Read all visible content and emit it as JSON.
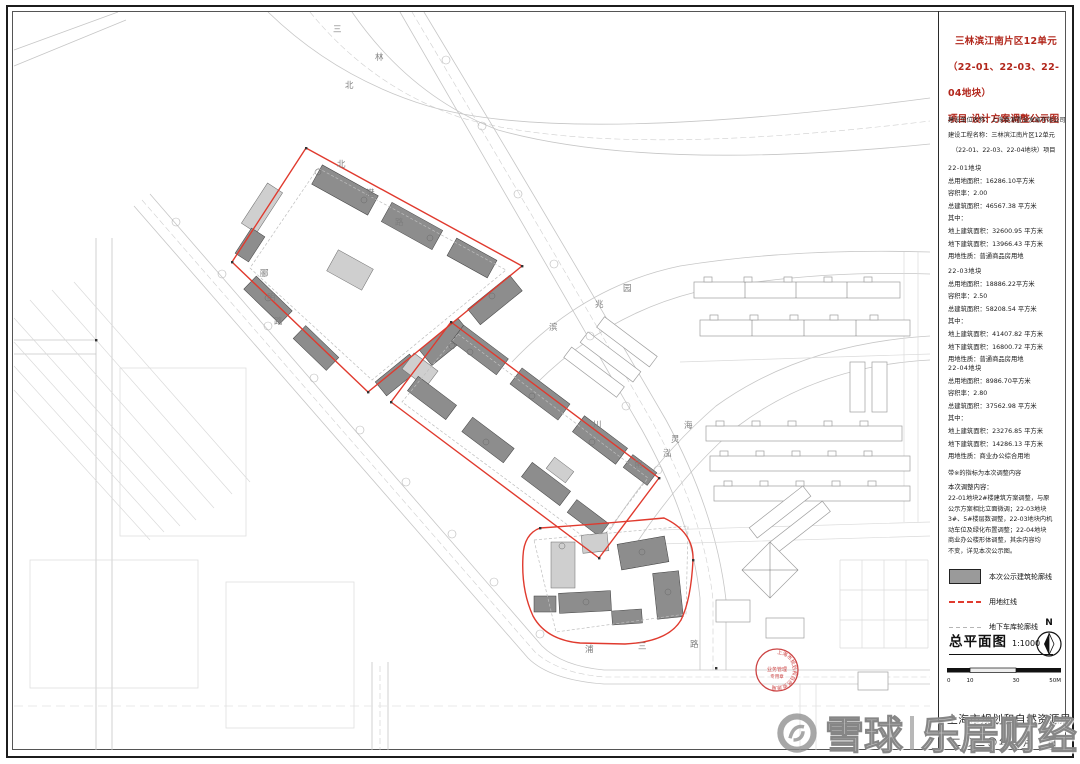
{
  "panel": {
    "title": [
      "三林滨江南片区12单元",
      "（22-01、22-03、22-04地块）",
      "项目 设计方案调整公示图"
    ],
    "meta": [
      "建设单位名称：上海临浦置业发展有限公司",
      "建设工程名称：三林滨江南片区12单元",
      "（22-01、22-03、22-04地块）项目"
    ],
    "parcels": [
      {
        "name": "22-01地块",
        "rows": [
          "总用地面积：16286.10平方米",
          "容积率：2.00",
          "总建筑面积：46567.38 平方米",
          "其中：",
          "地上建筑面积：32600.95 平方米",
          "地下建筑面积：13966.43 平方米",
          "用地性质：普通商品房用地"
        ]
      },
      {
        "name": "22-03地块",
        "rows": [
          "总用地面积：18886.22平方米",
          "容积率：2.50",
          "总建筑面积：58208.54 平方米",
          "其中：",
          "地上建筑面积：41407.82 平方米",
          "地下建筑面积：16800.72 平方米",
          "用地性质：普通商品房用地"
        ]
      },
      {
        "name": "22-04地块",
        "rows": [
          "总用地面积：8986.70平方米",
          "容积率：2.80",
          "总建筑面积：37562.98 平方米",
          "其中：",
          "地上建筑面积：23276.85 平方米",
          "地下建筑面积：14286.13 平方米",
          "用地性质：商业办公综合用地"
        ]
      }
    ],
    "flag_note": "带※的指标为本次调整内容",
    "note_title": "本次调整内容：",
    "note_lines": [
      "22-01地块2#楼建筑方案调整，与原",
      "公示方案相比立面微调；22-03地块",
      "3#、5#楼层数调整，22-03地块内机",
      "动车位及绿化布置调整；22-04地块",
      "商业办公楼形体调整，其余内容均",
      "不变，详见本次公示图。"
    ],
    "legend": [
      {
        "label": "本次公示建筑轮廓线"
      },
      {
        "label": "用地红线"
      },
      {
        "label": "地下车库轮廓线"
      }
    ],
    "plan_label": "总平面图",
    "plan_scale": "1:1000",
    "north": "N",
    "scalebar": [
      "0",
      "10",
      "30",
      "50M"
    ],
    "agency": "上海市规划和自然资源局",
    "date": "二〇二〇年　月　日"
  },
  "map": {
    "streets": [
      {
        "c": "三"
      },
      {
        "c": "林"
      },
      {
        "c": "北"
      },
      {
        "c": "北"
      },
      {
        "c": "港"
      },
      {
        "c": "路"
      },
      {
        "c": "郦"
      },
      {
        "c": "明"
      },
      {
        "c": "路"
      },
      {
        "c": "滨"
      },
      {
        "c": "兆"
      },
      {
        "c": "园"
      },
      {
        "c": "川"
      },
      {
        "c": "南"
      },
      {
        "c": "泓"
      },
      {
        "c": "灵"
      },
      {
        "c": "海"
      },
      {
        "c": "浦"
      },
      {
        "c": "三"
      },
      {
        "c": "路"
      }
    ],
    "stamp": {
      "ring": "上海市规划和自然资源局",
      "line1": "业务管理",
      "line2": "专用章"
    }
  },
  "watermark": {
    "brand1": "雪球",
    "brand2": "乐居财经"
  },
  "colors": {
    "red_line": "#e03a2e",
    "building_dark": "#8d8d8d",
    "building_light": "#cfcfcf",
    "title_red": "#b2271c",
    "stamp_red": "#cc4444"
  }
}
